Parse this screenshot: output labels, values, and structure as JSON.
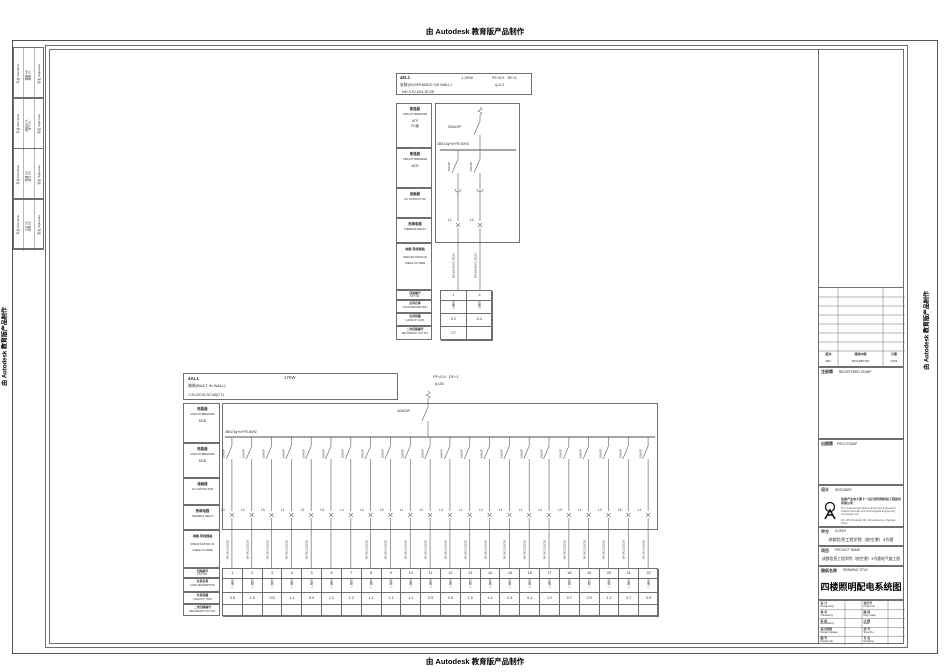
{
  "banner": {
    "text": "由 Autodesk 教育版产品制作"
  },
  "colors": {
    "line": "#6f6f6f",
    "text": "#2b2b2b"
  },
  "signature_strip": {
    "discipline_header": "专业 Discipline",
    "signature_header": "签名 Signature",
    "groups": [
      {
        "entries": "建筑 AR\n结构 ST"
      },
      {
        "entries": "给排水 PL\n电气 EL"
      },
      {
        "entries": "暖通 HV\n动力 PD"
      },
      {
        "entries": "工艺 TE\n总图 GE"
      }
    ]
  },
  "panel_el1": {
    "title": "4EL1",
    "power": "1.2KW",
    "pf_df": "PF=0.9   DF=1",
    "mounting": "安装(SUSPENDED ON WALL)",
    "ij": "Ij=2.2",
    "feeder_cable": "NH-YJV-5X4,SC25",
    "main_breaker": "25A/3P",
    "bus_label": "380V,3φ+N+PE,50HZ",
    "left_rows": [
      {
        "zh": "断路器",
        "en": "CIRCUIT BREAKER",
        "extra": "ATS\nPC级"
      },
      {
        "zh": "断路器",
        "en": "CIRCUIT BREAKER",
        "extra": "MCB"
      },
      {
        "zh": "接触器",
        "en": "AC CONTACTOR",
        "extra": ""
      },
      {
        "zh": "热继电器",
        "en": "THERMAL RELAY",
        "extra": ""
      }
    ],
    "spec_row": {
      "zh": "电缆·导线规格",
      "en1": "SPECIFICATION OF",
      "en2": "CABLE OF WIRE"
    },
    "table_rows": [
      {
        "zh": "回路编号",
        "en": "CKT NO."
      },
      {
        "zh": "负荷名称",
        "en": "LOAD DESCRIPTION"
      },
      {
        "zh": "负荷容量",
        "en": "CAPACITY (KW)"
      },
      {
        "zh": "二次回路编号",
        "en": "SECONDARY CKT NO."
      }
    ],
    "branches": [
      {
        "ckt": "1",
        "phase": "L1",
        "breaker": "16A/1P",
        "wire": "NH-BV-4X2.5,SC20",
        "load": "照明",
        "capacity": "0.2",
        "secondary": "C7"
      },
      {
        "ckt": "2",
        "phase": "L2",
        "breaker": "16A/1P",
        "wire": "NH-BV-4X2.5,SC20",
        "load": "照明",
        "capacity": "0.4",
        "secondary": ""
      }
    ]
  },
  "panel_al1": {
    "title": "4AL1",
    "power": "17KW",
    "pf_df": "PF=0.9   DF=1",
    "mounting": "暗装(BUILT IN WALL)",
    "ij": "Ij=28",
    "feeder_cable": "YJV-5X10,SC40(CT)",
    "main_breaker": "40A/3P",
    "bus_label": "380V,3φ+N+PE,50HZ",
    "left_rows": [
      {
        "zh": "断路器",
        "en": "CIRCUIT BREAKER",
        "extra": "MCB"
      },
      {
        "zh": "断路器",
        "en": "CIRCUIT BREAKER",
        "extra": "MCB"
      },
      {
        "zh": "接触器",
        "en": "AC CONTACTOR",
        "extra": ""
      },
      {
        "zh": "热继电器",
        "en": "THERMAL RELAY",
        "extra": ""
      }
    ],
    "spec_row": {
      "zh": "电缆·导线规格",
      "en1": "SPECIFICATION OF",
      "en2": "CABLE OF WIRE"
    },
    "table_rows": [
      {
        "zh": "回路编号",
        "en": "CKT NO."
      },
      {
        "zh": "负荷名称",
        "en": "LOAD DESCRIPTION"
      },
      {
        "zh": "负荷容量",
        "en": "CAPACITY (KW)"
      },
      {
        "zh": "二次回路编号",
        "en": "SECONDARY CKT NO."
      }
    ],
    "branches": [
      {
        "ckt": "1",
        "phase": "L1",
        "breaker": "16A/1P",
        "wire": "BV-3X2.5,SC20",
        "load": "照明",
        "capacity": "0.6",
        "secondary": ""
      },
      {
        "ckt": "2",
        "phase": "L2",
        "breaker": "16A/1P",
        "wire": "BV-3X2.5,SC20",
        "load": "照明",
        "capacity": "1.5",
        "secondary": ""
      },
      {
        "ckt": "3",
        "phase": "L3",
        "breaker": "16A/1P",
        "wire": "BV-3X2.5,SC20",
        "load": "照明",
        "capacity": "0.8",
        "secondary": ""
      },
      {
        "ckt": "4",
        "phase": "L1",
        "breaker": "16A/1P",
        "wire": "BV-3X2.5,SC20",
        "load": "照明",
        "capacity": "1.1",
        "secondary": ""
      },
      {
        "ckt": "5",
        "phase": "L2",
        "breaker": "16A/1P",
        "wire": "BV-3X2.5,SC20",
        "load": "照明",
        "capacity": "0.9",
        "secondary": ""
      },
      {
        "ckt": "6",
        "phase": "L3",
        "breaker": "16A/1P",
        "wire": "",
        "load": "照明",
        "capacity": "1.2",
        "secondary": ""
      },
      {
        "ckt": "7",
        "phase": "L1",
        "breaker": "16A/1P",
        "wire": "",
        "load": "照明",
        "capacity": "1.2",
        "secondary": ""
      },
      {
        "ckt": "8",
        "phase": "L2",
        "breaker": "16A/1P",
        "wire": "BV-3X2.5,SC20",
        "load": "照明",
        "capacity": "1.1",
        "secondary": ""
      },
      {
        "ckt": "9",
        "phase": "L3",
        "breaker": "16A/1P",
        "wire": "BV-3X2.5,SC20",
        "load": "照明",
        "capacity": "1.1",
        "secondary": ""
      },
      {
        "ckt": "10",
        "phase": "L1",
        "breaker": "16A/1P",
        "wire": "BV-3X2.5,SC20",
        "load": "照明",
        "capacity": "1.1",
        "secondary": ""
      },
      {
        "ckt": "11",
        "phase": "L2",
        "breaker": "16A/1P",
        "wire": "BV-3X2.5,SC20",
        "load": "照明",
        "capacity": "0.5",
        "secondary": ""
      },
      {
        "ckt": "12",
        "phase": "L3",
        "breaker": "16A/1P",
        "wire": "BV-3X2.5,SC20",
        "load": "照明",
        "capacity": "0.5",
        "secondary": ""
      },
      {
        "ckt": "13",
        "phase": "L1",
        "breaker": "16A/1P",
        "wire": "BV-3X2.5,SC20",
        "load": "照明",
        "capacity": "1.5",
        "secondary": ""
      },
      {
        "ckt": "14",
        "phase": "L2",
        "breaker": "16A/1P",
        "wire": "BV-3X2.5,SC20",
        "load": "照明",
        "capacity": "1.4",
        "secondary": ""
      },
      {
        "ckt": "15",
        "phase": "L3",
        "breaker": "16A/1P",
        "wire": "BV-3X2.5,SC20",
        "load": "照明",
        "capacity": "0.4",
        "secondary": ""
      },
      {
        "ckt": "16",
        "phase": "L1",
        "breaker": "16A/1P",
        "wire": "BV-3X2.5,SC20",
        "load": "照明",
        "capacity": "0.4",
        "secondary": ""
      },
      {
        "ckt": "17",
        "phase": "L2",
        "breaker": "16A/1P",
        "wire": "BV-3X2.5,SC20",
        "load": "照明",
        "capacity": "1.2",
        "secondary": ""
      },
      {
        "ckt": "18",
        "phase": "L3",
        "breaker": "16A/1P",
        "wire": "BV-3X2.5,SC20",
        "load": "照明",
        "capacity": "0.7",
        "secondary": ""
      },
      {
        "ckt": "19",
        "phase": "L1",
        "breaker": "16A/1P",
        "wire": "BV-3X2.5,SC20",
        "load": "照明",
        "capacity": "0.9",
        "secondary": ""
      },
      {
        "ckt": "20",
        "phase": "L2",
        "breaker": "16A/1P",
        "wire": "BV-3X2.5,SC20",
        "load": "照明",
        "capacity": "1.2",
        "secondary": ""
      },
      {
        "ckt": "21",
        "phase": "L3",
        "breaker": "16A/1P",
        "wire": "BV-3X2.5,SC20",
        "load": "照明",
        "capacity": "0.7",
        "secondary": ""
      },
      {
        "ckt": "22",
        "phase": "L1",
        "breaker": "16A/1P",
        "wire": "BV-3X2.5,SC20",
        "load": "照明",
        "capacity": "0.9",
        "secondary": ""
      }
    ]
  },
  "title_block": {
    "revision_headers": [
      {
        "zh": "版次",
        "en": "REV."
      },
      {
        "zh": "修改内容",
        "en": "DESCRIPTION"
      },
      {
        "zh": "日期",
        "en": "DATE"
      }
    ],
    "registered_stamp": {
      "zh": "注册章",
      "en": "REGISTERED STAMP"
    },
    "proj_stamp": {
      "zh": "出图章",
      "en": "PROJ STAMP"
    },
    "designer": {
      "zh": "设计",
      "en": "DESIGNER",
      "company_zh": "信息产业电子第十一设计研究院科技工程股份有限公司",
      "company_en": "The 11 Electronics (Eleventh) Design & Research Institute Scientific and Technological Engineering Corporation Ltd.",
      "company_addr": "NO. 281 Shuanglin Rd. Jinhua Avenue, Chengdu, China"
    },
    "client": {
      "zh": "甲方",
      "en": "CLIENT",
      "value": "成都信息工程学院（航空港）4号楼"
    },
    "project": {
      "zh": "项目",
      "en": "PROJECT NAME",
      "value": "成都信息工程学院（航空港）4号楼电气施工图"
    },
    "drawing": {
      "zh": "图纸名称",
      "en": "DRAWING TITLE",
      "value": "四楼照明配电系统图"
    },
    "grid_rows": [
      {
        "l_zh": "设 计",
        "l_en": "Designed by",
        "r_zh": "项目号",
        "r_en": "Project No."
      },
      {
        "l_zh": "校 对",
        "l_en": "Checked by",
        "r_zh": "图 别",
        "r_en": "Dwg. Stage"
      },
      {
        "l_zh": "审 核",
        "l_en": "Reviewed by",
        "r_zh": "比 例",
        "r_en": "Scale"
      },
      {
        "l_zh": "设计经理",
        "l_en": "Design Manager",
        "r_zh": "张 号",
        "r_en": "Sheet No."
      },
      {
        "l_zh": "图 号",
        "l_en": "Drawing No.",
        "r_zh": "专 业",
        "r_en": "Discipline"
      }
    ]
  }
}
